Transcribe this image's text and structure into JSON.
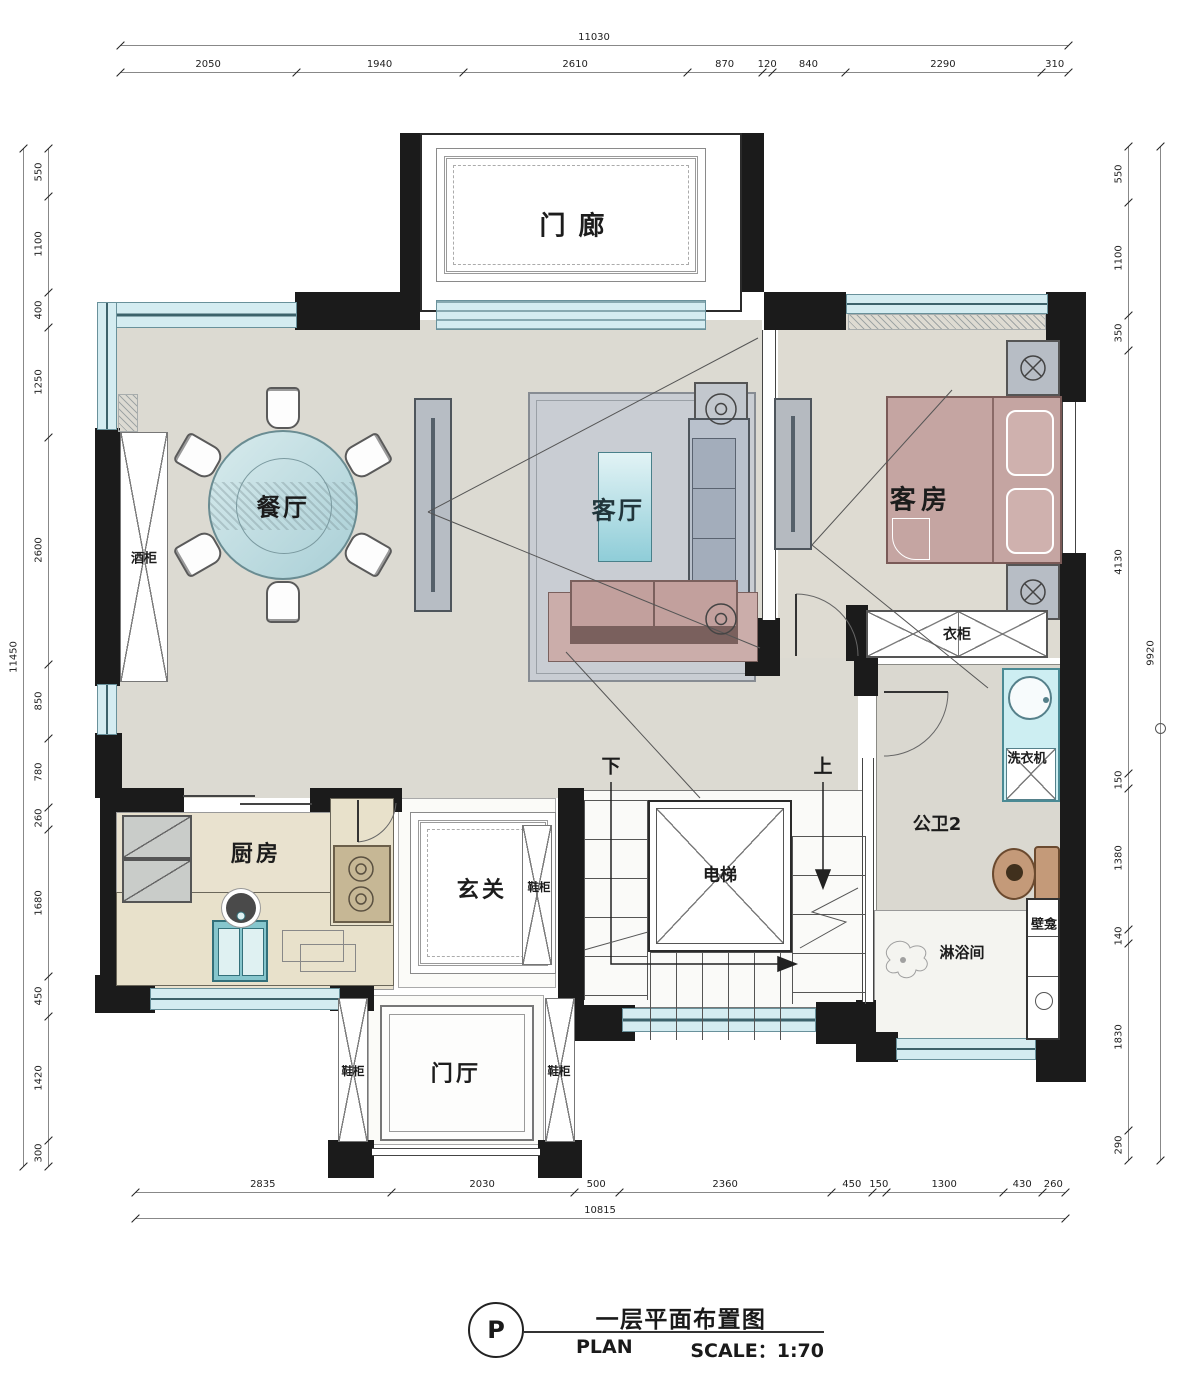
{
  "title": {
    "marker": "P",
    "zh": "一层平面布置图",
    "en": "PLAN",
    "scale": "SCALE：1:70"
  },
  "rooms": {
    "porch": "门廊",
    "dining": "餐厅",
    "living": "客厅",
    "guest": "客房",
    "kitchen": "厨房",
    "entry": "玄关",
    "foyer": "门厅",
    "elevator": "电梯",
    "bath": "公卫2",
    "shower": "淋浴间"
  },
  "fixtures": {
    "wine_cabinet": "酒柜",
    "wardrobe": "衣柜",
    "washer": "洗衣机",
    "niche": "壁龛",
    "shoe_cabinets": [
      "鞋柜",
      "鞋柜",
      "鞋柜"
    ],
    "stair_down": "下",
    "stair_up": "上"
  },
  "dimensions": {
    "top": {
      "total": "11030",
      "segments": [
        "2050",
        "1940",
        "2610",
        "870",
        "120",
        "840",
        "2290",
        "310"
      ]
    },
    "bottom": {
      "total": "10815",
      "segments": [
        "2835",
        "2030",
        "500",
        "2360",
        "450",
        "150",
        "1300",
        "430",
        "260"
      ]
    },
    "left": {
      "total": "11450",
      "segments": [
        "550",
        "1100",
        "400",
        "1250",
        "2600",
        "850",
        "780",
        "260",
        "1680",
        "450",
        "1420",
        "300"
      ]
    },
    "right": {
      "total": "9920",
      "segments": [
        "550",
        "1100",
        "350",
        "4130",
        "150",
        "1380",
        "140",
        "1830",
        "290"
      ]
    }
  },
  "colors": {
    "wall": "#1b1b1b",
    "window": "#d4ecf1",
    "floor_main": "#dcdad2",
    "floor_kitchen": "#e9e2cf",
    "bed_sofa_mauve": "#c5a5a2",
    "sofa_gray": "#a9b2bf",
    "glass_teal": "#bfe0e6",
    "counter": "#e8e1cb",
    "toilet": "#c49a79"
  }
}
